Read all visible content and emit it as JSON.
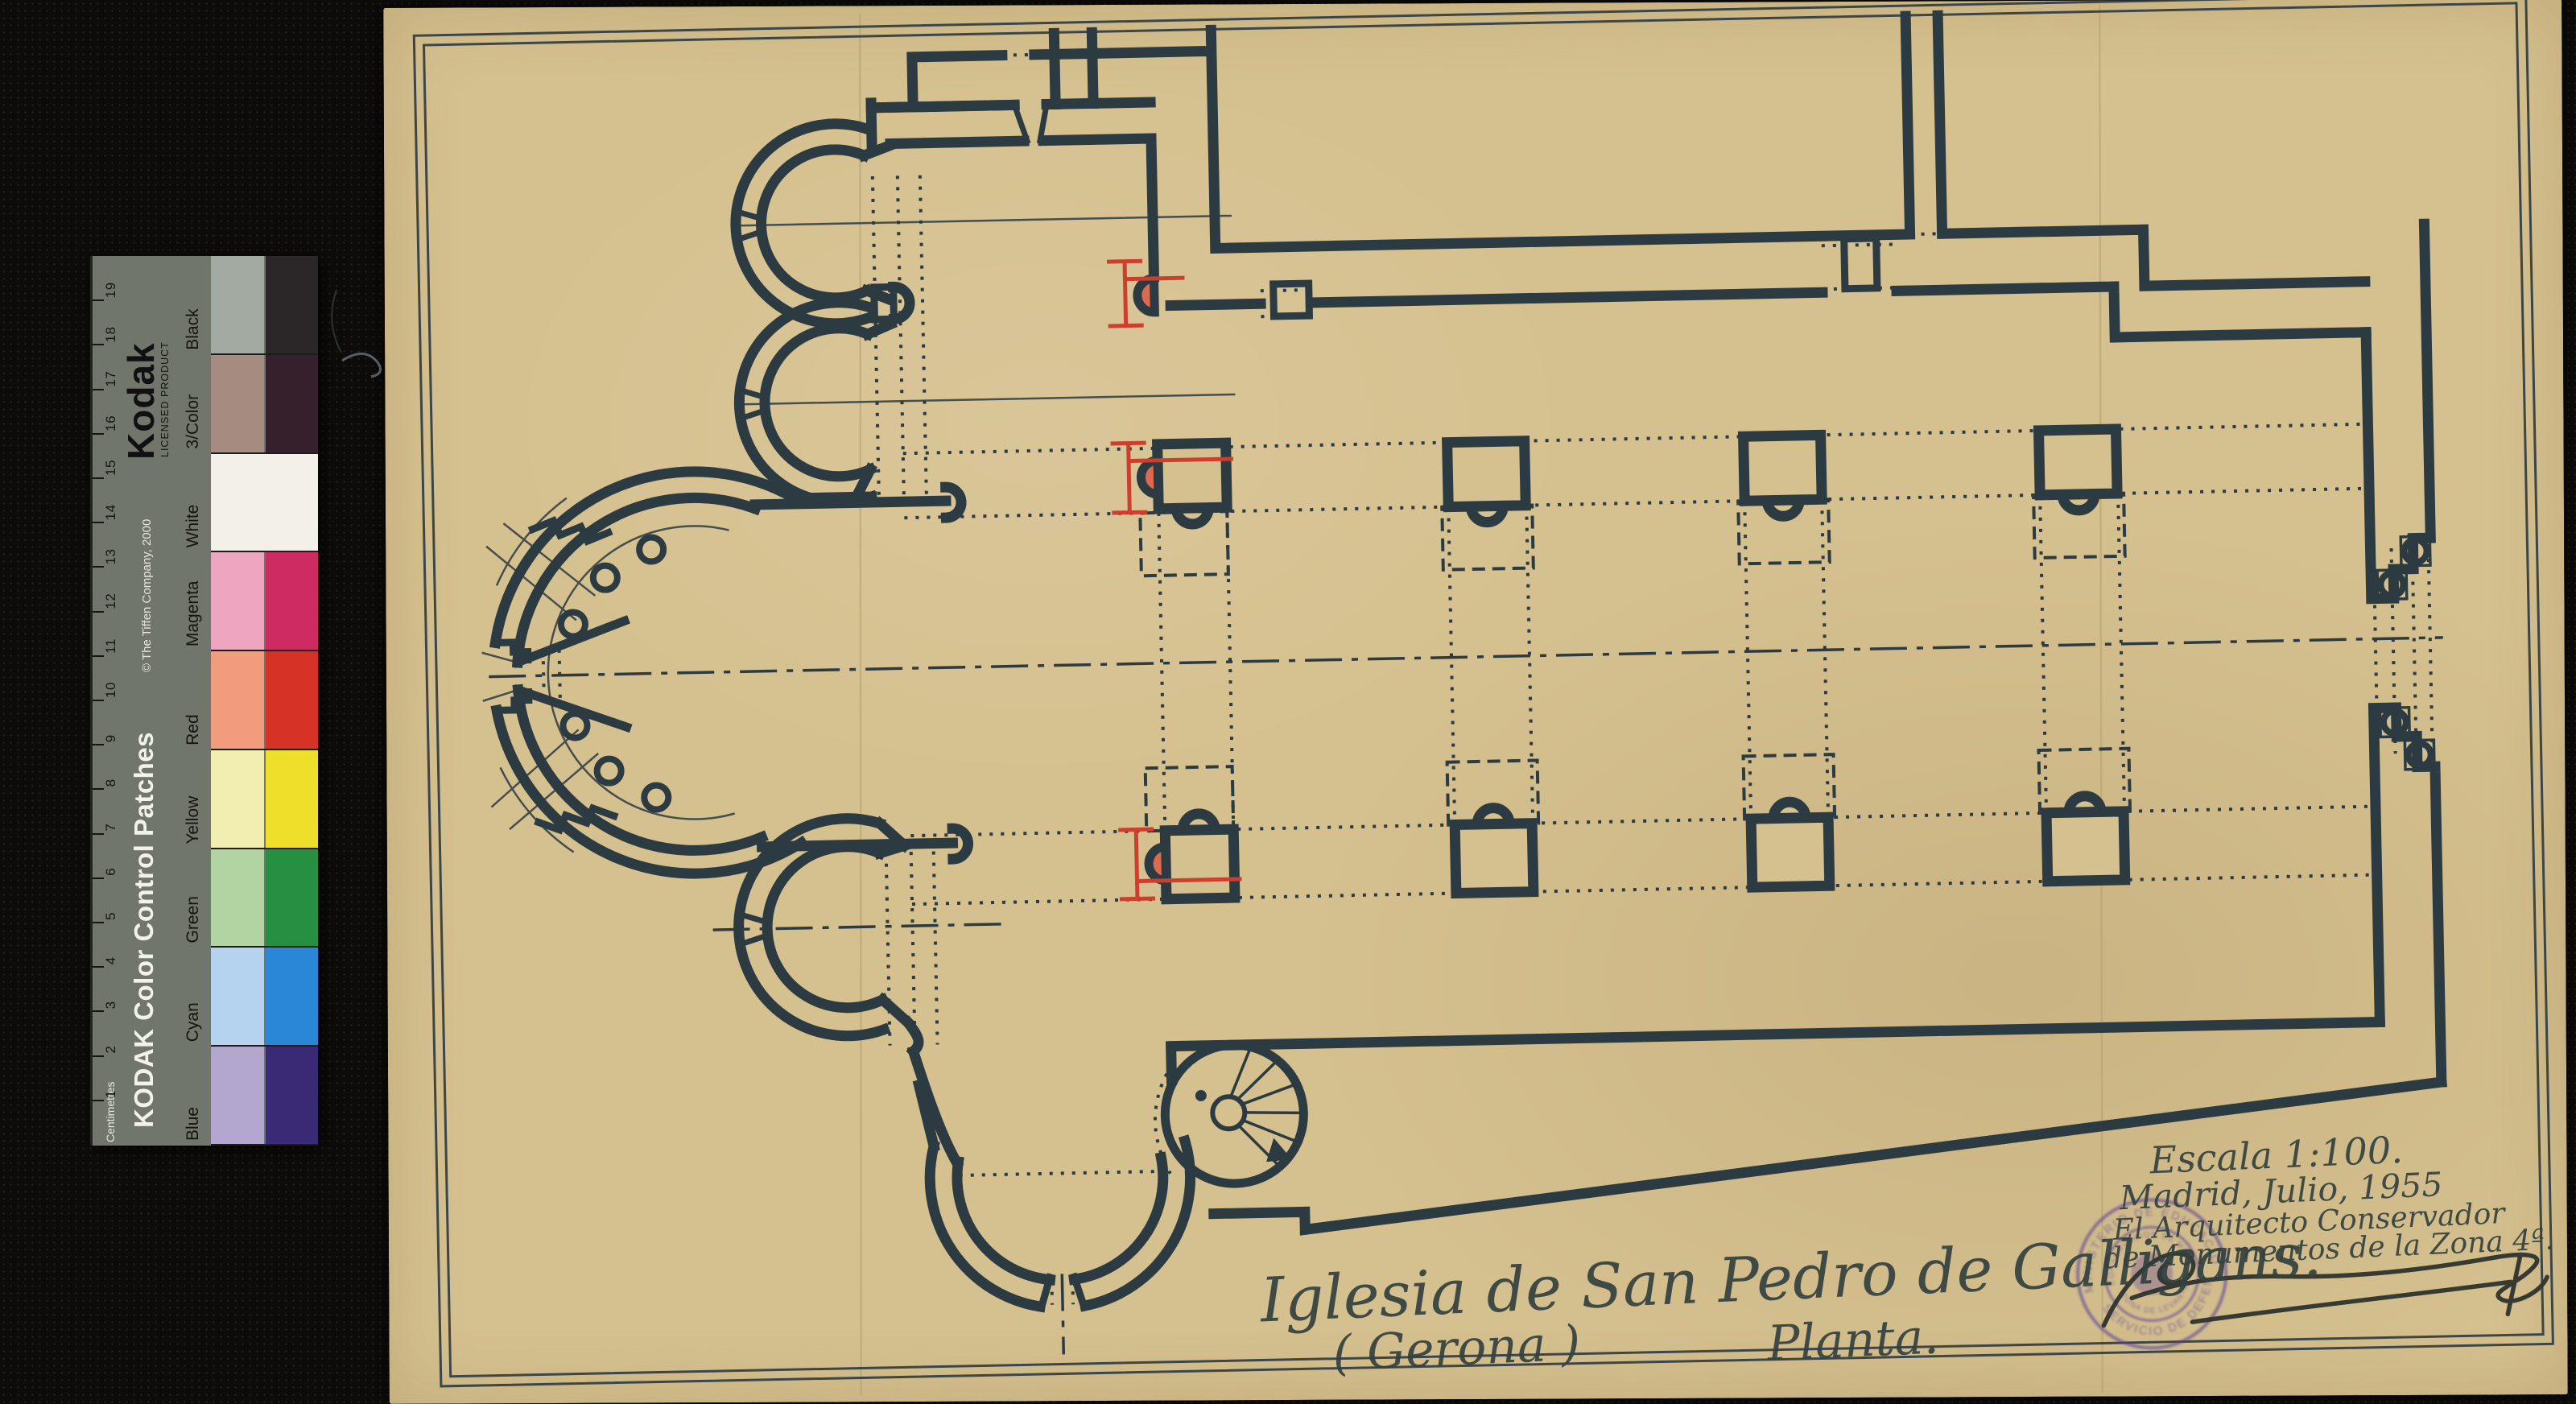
{
  "window": {
    "background": "#0d0c0a"
  },
  "color_bar": {
    "brand": "Kodak",
    "brand_sub": "LICENSED PRODUCT",
    "product": "KODAK Color Control Patches",
    "copyright": "© The Tiffen Company, 2000",
    "ruler_label": "Centimetres",
    "ruler_numbers": [
      1,
      2,
      3,
      4,
      5,
      6,
      7,
      8,
      9,
      10,
      11,
      12,
      13,
      14,
      15,
      16,
      17,
      18,
      19
    ],
    "background": "#70766c",
    "patches": [
      {
        "name": "Blue",
        "light": "#b3a6cf",
        "dark": "#3a2a75"
      },
      {
        "name": "Cyan",
        "light": "#b5d2ee",
        "dark": "#2a87d8"
      },
      {
        "name": "Green",
        "light": "#b2d3a2",
        "dark": "#268f42"
      },
      {
        "name": "Yellow",
        "light": "#f2eeb2",
        "dark": "#eedf2a"
      },
      {
        "name": "Red",
        "light": "#f29b7d",
        "dark": "#d63326"
      },
      {
        "name": "Magenta",
        "light": "#eea6c0",
        "dark": "#cf2b63"
      },
      {
        "name": "White",
        "light": "#f3f0e9",
        "dark": "#f3f0e9",
        "full": true
      },
      {
        "name": "3/Color",
        "light": "#a68c80",
        "dark": "#35202b"
      },
      {
        "name": "Black",
        "light": "#a3aaa1",
        "dark": "#2b2728",
        "hatch": true
      }
    ]
  },
  "sheet": {
    "paper_color": "#d5c08f",
    "ink_color": "#2c3a42",
    "highlight_color": "#cc3f2e",
    "title": "Iglesia de San Pedro de Galligans.",
    "subtitle": "( Gerona )",
    "plan_label": "Planta.",
    "scale_note": "Escala 1:100.",
    "date_note": "Madrid, Julio, 1955",
    "credit_line1": "El Arquitecto Conservador",
    "credit_line2": "de Monumentos de la Zona 4ª.",
    "highlighted_piers": 3,
    "stamp": {
      "color": "#5a3f9b",
      "text_top": "MINISTERIO DE EDUCACION",
      "text_bottom": "SERVICIO DE DEFENSA",
      "text_inner_top": "CONSERVACION DE MONUMENTOS",
      "text_inner_bottom": "ZONA DE LEVANTE",
      "text_right": "NACIONAL"
    }
  }
}
